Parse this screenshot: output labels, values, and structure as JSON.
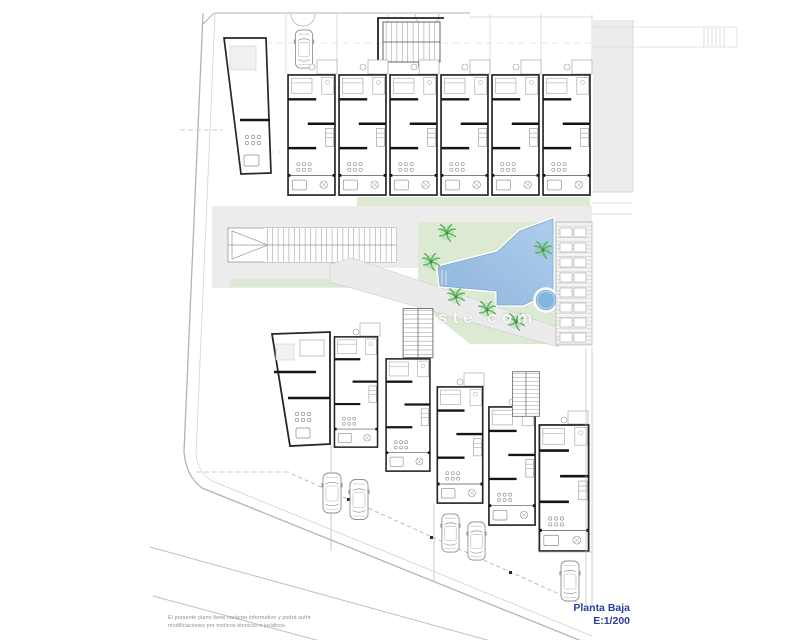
{
  "plan": {
    "title_block": {
      "title": "Planta Baja",
      "scale": "E:1/200"
    },
    "disclaimer": {
      "line1": "El presente plano tiene carácter informativo y podrá sufrir",
      "line2": "modificaciones por motivos técnicos o jurídicos."
    },
    "watermark": "ste.com",
    "colors": {
      "pool": "#aecdeb",
      "pool_deep": "#8fb6dd",
      "jacuzzi": "#85b4dd",
      "green": "#dcead4",
      "palm": "#57b257",
      "wall": "#262626",
      "boundary": "#b3b3b3",
      "path_gray": "#ececec",
      "title_blue": "#2b3f9b",
      "disclaimer_gray": "#8f8f8f"
    }
  }
}
